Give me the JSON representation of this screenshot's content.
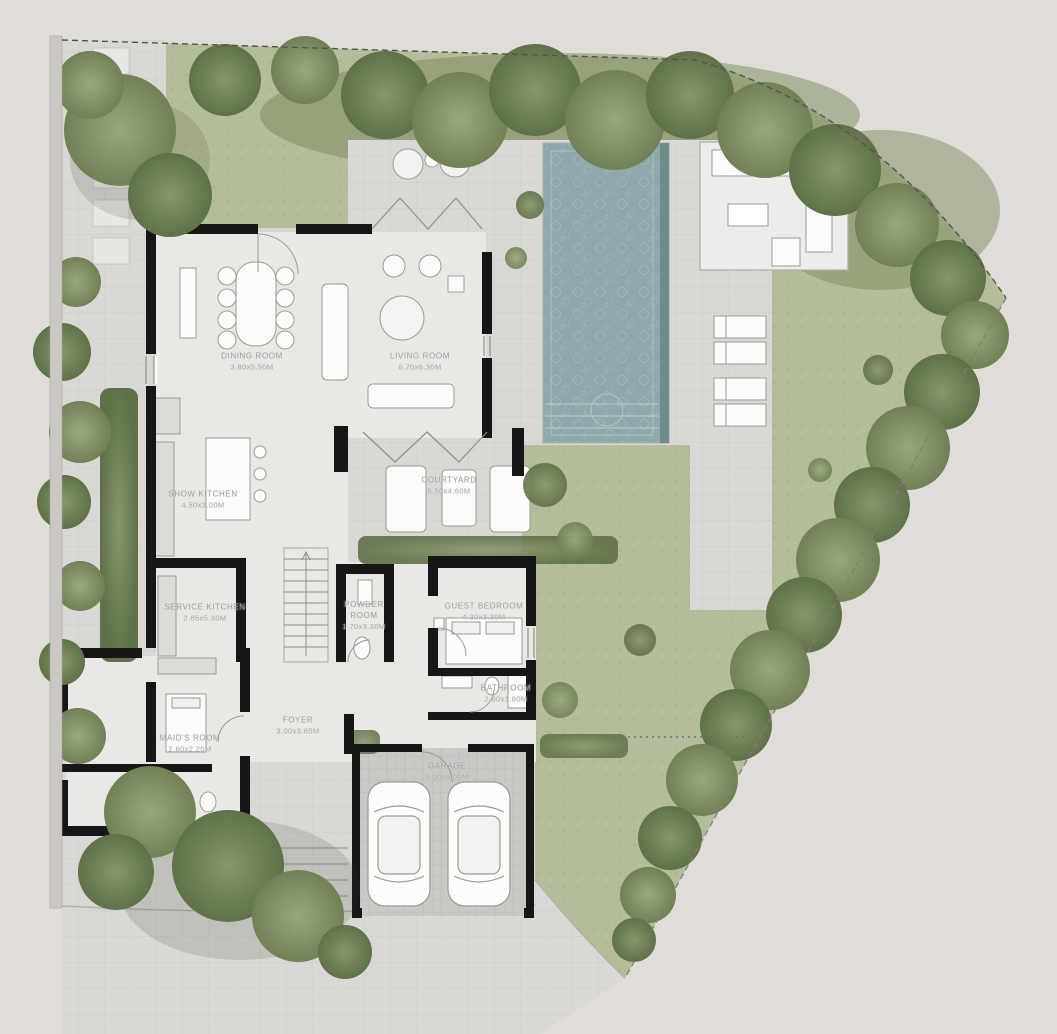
{
  "plan_type": "villa-ground-floor-site-plan",
  "rooms": [
    {
      "id": "dining-room",
      "name": "DINING ROOM",
      "dims": "3.80x5.50M"
    },
    {
      "id": "living-room",
      "name": "LIVING ROOM",
      "dims": "6.70x6.30M"
    },
    {
      "id": "show-kitchen",
      "name": "SHOW KITCHEN",
      "dims": "4.50x3.00M"
    },
    {
      "id": "courtyard",
      "name": "COURTYARD",
      "dims": "5.50x4.60M"
    },
    {
      "id": "service-kitchen",
      "name": "SERVICE KITCHEN",
      "dims": "2.85x5.30M"
    },
    {
      "id": "powder-room",
      "name": "POWDER ROOM",
      "dims": "1.70x3.30M"
    },
    {
      "id": "guest-bedroom",
      "name": "GUEST BEDROOM",
      "dims": "4.30x3.30M"
    },
    {
      "id": "bathroom",
      "name": "BATHROOM",
      "dims": "2.80x1.80M"
    },
    {
      "id": "foyer",
      "name": "FOYER",
      "dims": "3.00x3.85M"
    },
    {
      "id": "maids-room",
      "name": "MAID'S ROOM",
      "dims": "2.60x2.20M"
    },
    {
      "id": "garage",
      "name": "GARAGE",
      "dims": "6.00x6.00M"
    }
  ],
  "colors": {
    "background": "#e0ddd8",
    "lawn": "#b4bd9b",
    "shrub": "#7c8e61",
    "tree": "#8a9a72",
    "paving": "#d9d8d4",
    "pergola_deck": "#ecedeb",
    "pool_water": "#8fa8ab",
    "pool_shadow": "#64807f",
    "wall": "#161616",
    "floor": "#e9e8e5",
    "garage_floor": "#c9c9c6",
    "label_text": "#98a0a0",
    "furniture_stroke": "#9b9b98"
  }
}
